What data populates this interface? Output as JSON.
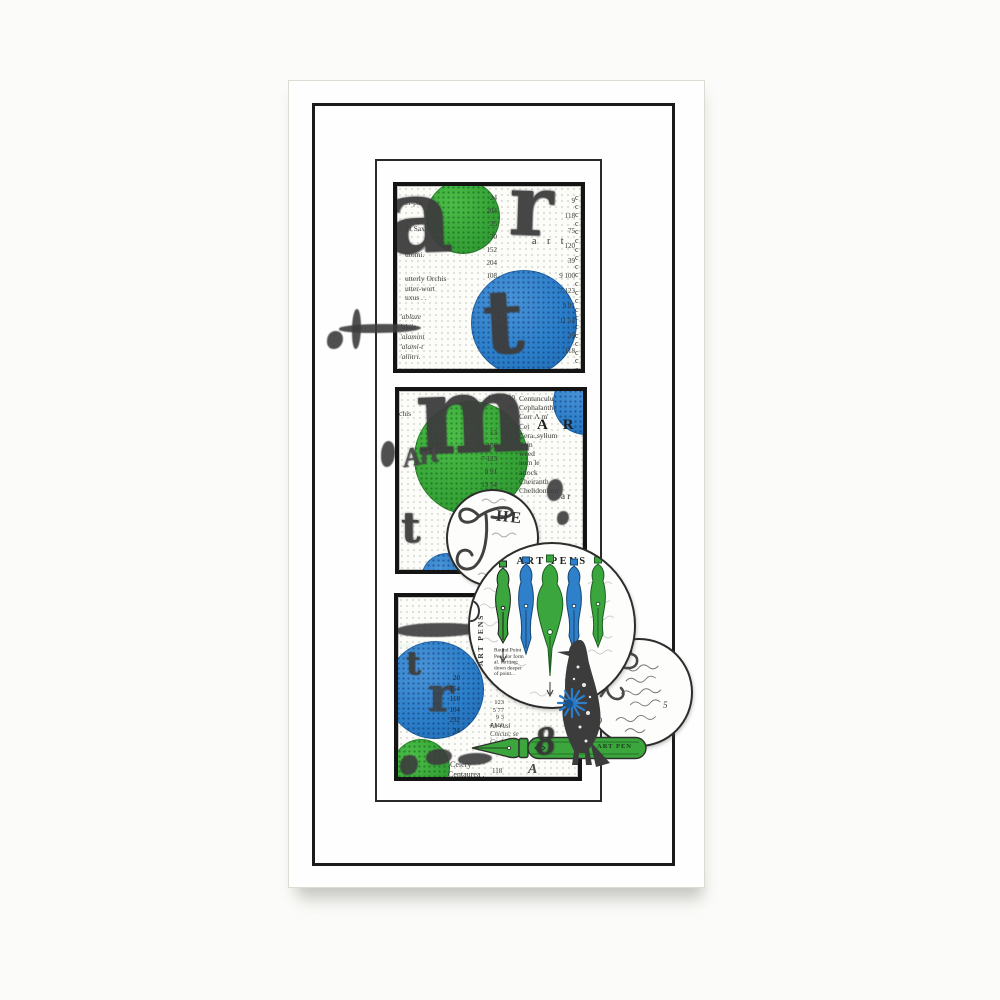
{
  "colors": {
    "green": "#3aa63c",
    "blue": "#2a7cc8",
    "ink": "#3a3a3a",
    "frame": "#1b1b1b",
    "paper": "#ffffff"
  },
  "panel1": {
    "gothic_a": "a",
    "gothic_r": "r",
    "gothic_t": "t",
    "typed_word": "a r t",
    "words_top": [
      "er-par.",
      "'et Sax",
      "utomi."
    ],
    "words_mid": [
      "utterly Orchis",
      "utter-wort",
      "uxus .  ."
    ],
    "words_low": [
      "'ablaze",
      "'akile",
      "'alamint",
      "'alami-t",
      "'allitri."
    ],
    "numbers_left": [
      "24",
      "204",
      "25",
      "70",
      "152",
      "204",
      "108"
    ],
    "numbers_right": [
      "9",
      "118",
      "75",
      "120",
      "39",
      "9 100",
      "7 123",
      "9 91",
      "11 54",
      "39",
      "118"
    ],
    "c_column": "ccccccccccccccccccccc"
  },
  "panel2": {
    "gothic_m": "m",
    "cursive_art": "Art",
    "gothic_t": "t",
    "word_left": "chis",
    "words_right": [
      "Centunculu",
      "Cephalanthe",
      "Cerr Λ m'",
      "Cet",
      "Cera.,syllum",
      "llum",
      "weed",
      "nom le",
      "arlock",
      "Cheiranth",
      "Chelidonium"
    ],
    "stamp_caps": "A R",
    "stamp_small": "a r",
    "numbers_top": [
      "4 108  120",
      "39"
    ],
    "numbers_mid": [
      "13",
      "9 100",
      "7 123",
      "8 91",
      "13 54",
      "11 39",
      "1 118"
    ]
  },
  "panel3": {
    "gothic_r": "r",
    "gothic_t": "t",
    "word_tiny": "scese",
    "numbers_blue": [
      "20",
      "154",
      "110",
      "104",
      "232",
      "34"
    ],
    "numbers_col": [
      "123",
      "5 77",
      "9 3",
      "4 160"
    ],
    "words_mid": [
      "Ab-rusl",
      "Cnicus; se",
      "Cochleari"
    ],
    "word_bottom_1": "Celery · · ·",
    "word_bottom_2": "Centaurea .",
    "number_bottom": "118",
    "script_a": "A"
  },
  "the_circle": {
    "initial": "T",
    "rest": "HE"
  },
  "art_pens_circle": {
    "title": "ART PENS",
    "side_label": "ART PENS",
    "body_lines": [
      "Round Point",
      "Pens for form",
      "al. furiting:",
      "down deeper",
      "of point..."
    ],
    "caption_lines": [
      "ART PENS",
      "THREE DEG.",
      "OF POIN"
    ]
  },
  "script_circle": {
    "number_a": "89",
    "number_b": "5"
  },
  "pen_stamp": {
    "label": "ART PEN"
  },
  "ink_numeral": "8"
}
